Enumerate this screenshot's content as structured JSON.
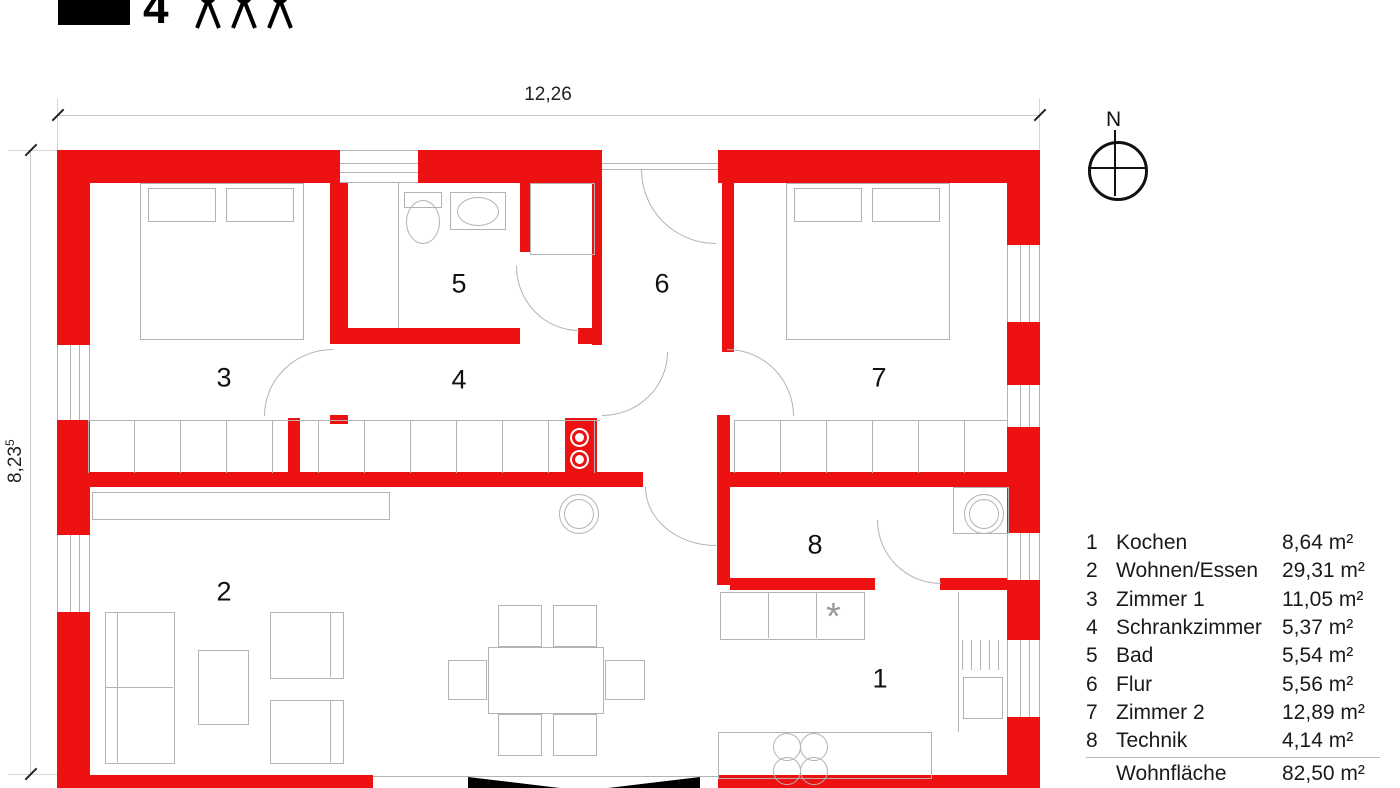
{
  "logo": {
    "number": "4",
    "people_count": "3"
  },
  "north": {
    "label": "N"
  },
  "dimensions": {
    "width_label": "12,26",
    "height_label": "8,23",
    "height_sup": "5"
  },
  "symbols": {
    "appliance_marker": "*"
  },
  "rooms": [
    {
      "number": "1",
      "name": "Kochen"
    },
    {
      "number": "2",
      "name": "Wohnen/Essen"
    },
    {
      "number": "3",
      "name": "Zimmer 1"
    },
    {
      "number": "4",
      "name": "Schrankzimmer"
    },
    {
      "number": "5",
      "name": "Bad"
    },
    {
      "number": "6",
      "name": "Flur"
    },
    {
      "number": "7",
      "name": "Zimmer 2"
    },
    {
      "number": "8",
      "name": "Technik"
    }
  ],
  "legend": {
    "rows": [
      {
        "num": "1",
        "name": "Kochen",
        "area": "8,64 m²"
      },
      {
        "num": "2",
        "name": "Wohnen/Essen",
        "area": "29,31 m²"
      },
      {
        "num": "3",
        "name": "Zimmer 1",
        "area": "11,05 m²"
      },
      {
        "num": "4",
        "name": "Schrankzimmer",
        "area": "5,37 m²"
      },
      {
        "num": "5",
        "name": "Bad",
        "area": "5,54 m²"
      },
      {
        "num": "6",
        "name": "Flur",
        "area": "5,56 m²"
      },
      {
        "num": "7",
        "name": "Zimmer 2",
        "area": "12,89 m²"
      },
      {
        "num": "8",
        "name": "Technik",
        "area": "4,14 m²"
      }
    ],
    "summary": [
      {
        "name": "Wohnfläche",
        "area": "82,50 m²"
      },
      {
        "name": "Grundfläche",
        "area": "100,96 m²"
      }
    ]
  },
  "colors": {
    "wall_red": "#ee1111",
    "line_gray": "#b3b3b3",
    "text": "#1a1a1a"
  }
}
